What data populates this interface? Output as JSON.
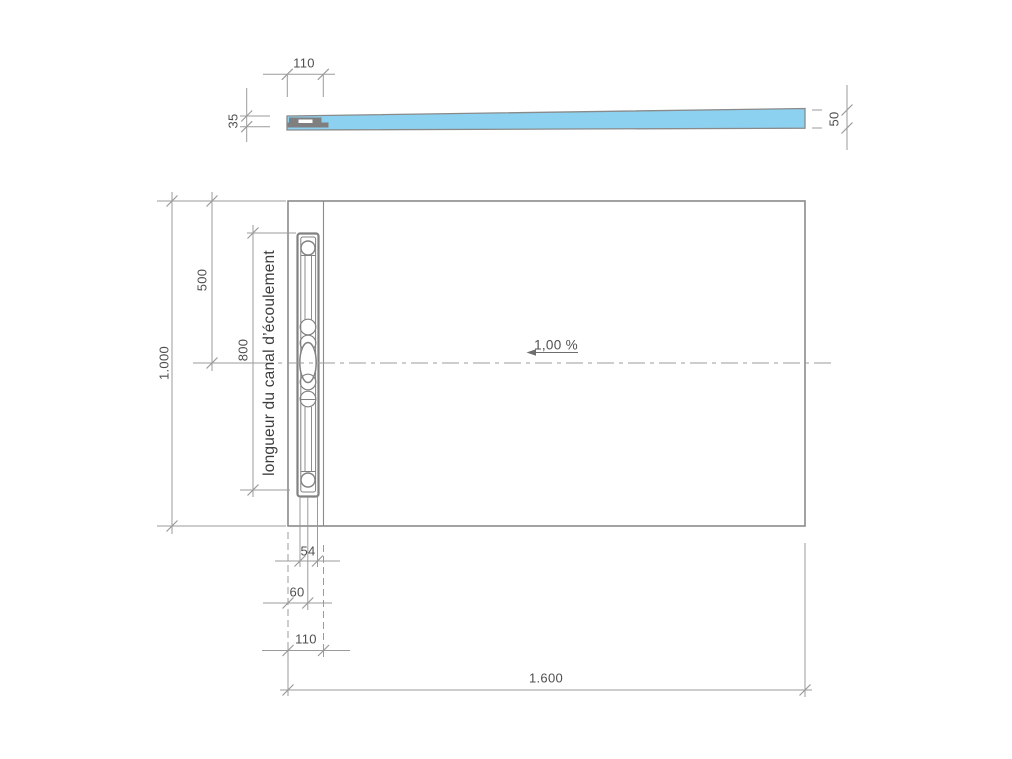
{
  "drawing": {
    "type": "technical-drawing",
    "subject": "shower floor element with drain channel",
    "colors": {
      "tray_fill": "#8CD1F0",
      "object_line": "#8A8A8A",
      "dim_line": "#9B9B9B",
      "dim_text": "#4F4F4F",
      "label_text": "#3C3C3C"
    },
    "section_view": {
      "dims": {
        "edge_width": "110",
        "thickness_left": "35",
        "thickness_right": "50"
      }
    },
    "plan_view": {
      "dims": {
        "overall_width": "1.000",
        "channel_center_offset": "500",
        "channel_length": "800",
        "channel_width": "54",
        "channel_outer_width": "60",
        "edge_zone_width": "110",
        "overall_length": "1.600"
      },
      "labels": {
        "channel": "longueur du canal d’écoulement",
        "slope": "1,00 %"
      }
    }
  }
}
